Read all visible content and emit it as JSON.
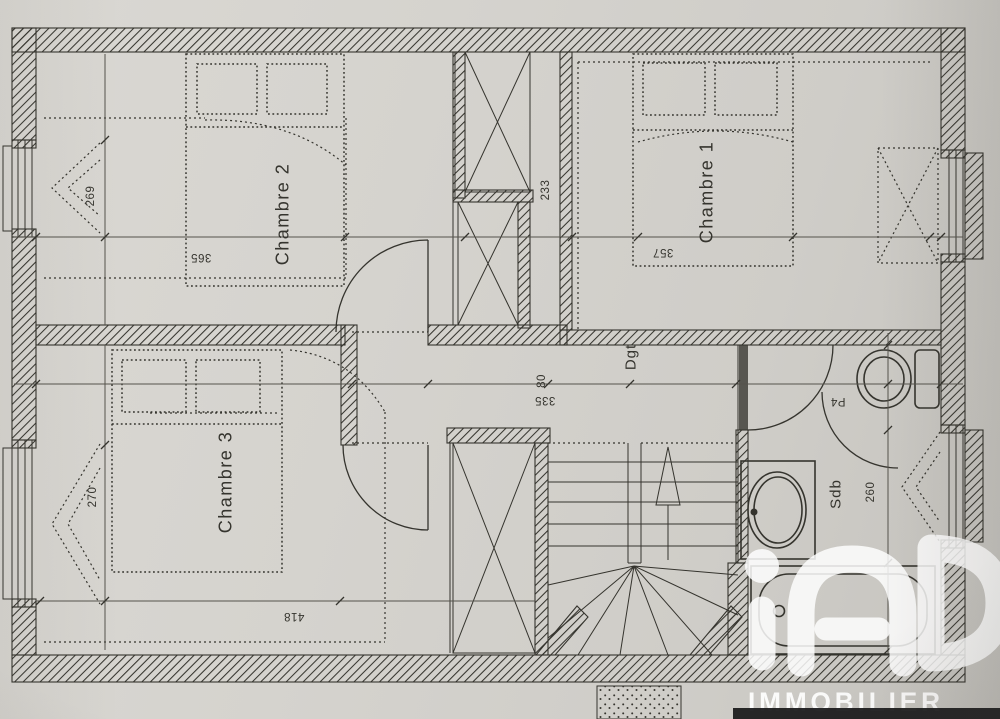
{
  "colors": {
    "paper": "#d5d3ce",
    "paper2": "#c8c6c1",
    "ink": "#35342e",
    "ink_soft": "#55534c",
    "logo": "#ffffff",
    "strip": "#1c1c1e"
  },
  "rooms": {
    "chambre1": "Chambre 1",
    "chambre2": "Chambre 2",
    "chambre3": "Chambre 3",
    "landing": "Dgt",
    "bathroom": "Sdb"
  },
  "dimensions": {
    "left_upper": "269",
    "left_lower": "270",
    "closet_column": "233",
    "chambre2_width": "365",
    "chambre1_width": "357",
    "chambre3_width": "418",
    "landing_opening": "80",
    "landing_length": "335",
    "bathroom_width": "260",
    "bathroom_door": "P4"
  },
  "logo": {
    "brand": "iad",
    "subtitle": "IMMOBILIER"
  }
}
